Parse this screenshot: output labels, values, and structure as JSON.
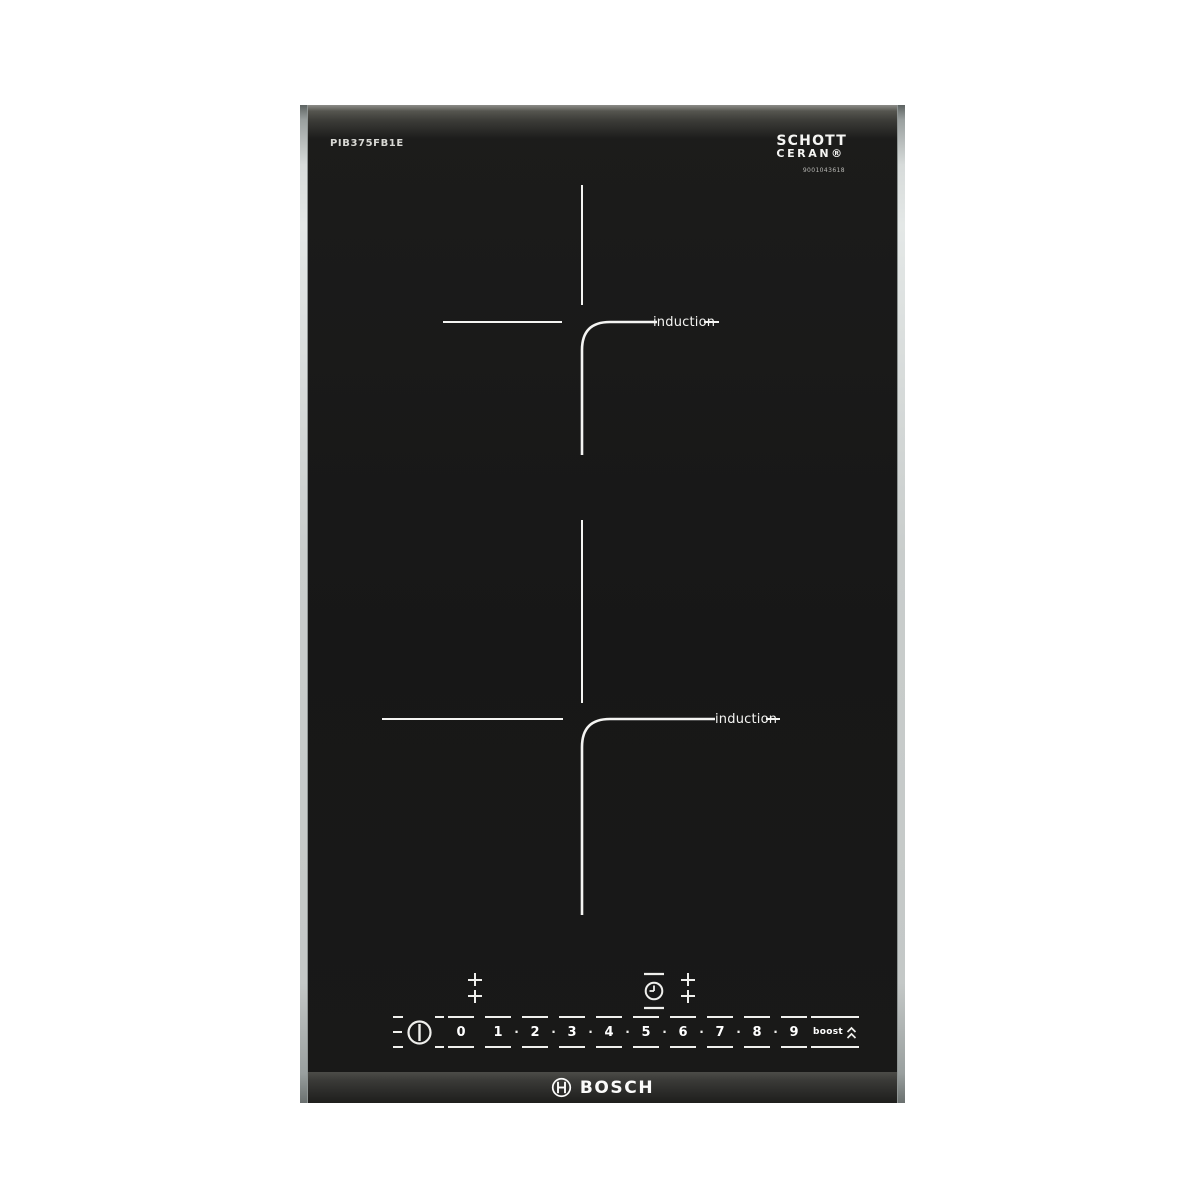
{
  "labels": {
    "model": "PIB375FB1E",
    "glass_brand_line1": "SCHOTT",
    "glass_brand_line2": "CERAN®",
    "glass_serial": "9001043618",
    "brand": "BOSCH"
  },
  "zones": [
    {
      "name": "top-zone",
      "label": "induction"
    },
    {
      "name": "bottom-zone",
      "label": "induction"
    }
  ],
  "controls": {
    "separator": "·",
    "levels": [
      "0",
      "1",
      "2",
      "3",
      "4",
      "5",
      "6",
      "7",
      "8",
      "9"
    ],
    "boost_label": "boost",
    "icons": {
      "power": "power-icon",
      "zone_select": "zone-select-icon",
      "timer": "timer-clock-icon",
      "boost": "double-chevron-up-icon",
      "brand_emblem": "bosch-armature-icon"
    }
  },
  "colors": {
    "background": "#ffffff",
    "glass": "#181818",
    "marking_white": "#f4f4f2",
    "trim_steel": "#c9cdcc",
    "bevel_gray": "#3a3a37"
  }
}
